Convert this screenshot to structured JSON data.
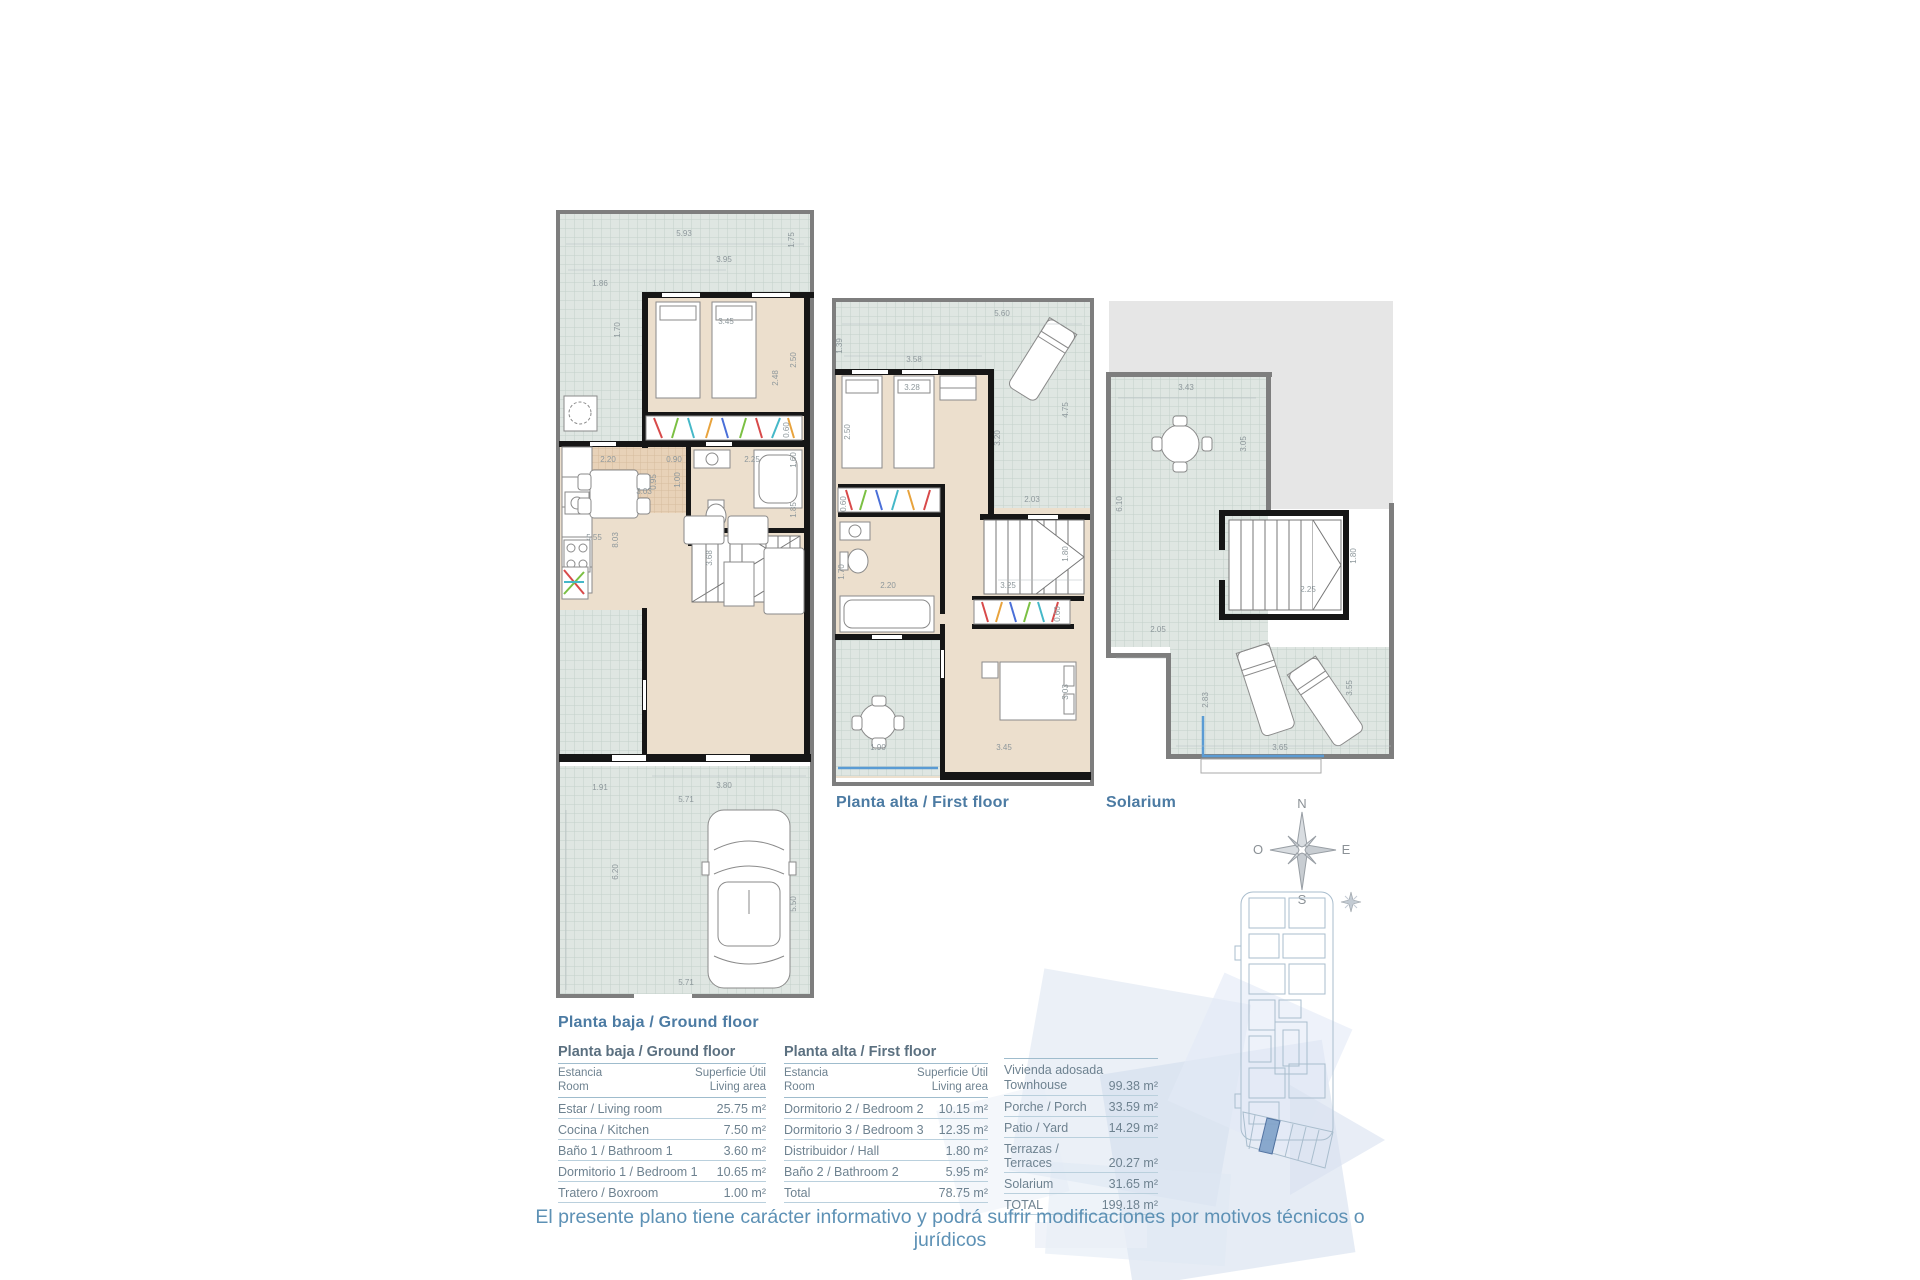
{
  "plans": {
    "ground": {
      "label": "Planta baja / Ground floor",
      "dims": [
        "5.93",
        "1.75",
        "3.95",
        "1.86",
        "1.70",
        "3.45",
        "2.50",
        "2.48",
        "0.60",
        "2.20",
        "0.90",
        "2.25",
        "1.60",
        "8.03",
        "1.00",
        "0.95",
        "3.03",
        "5.55",
        "3.68",
        "1.85",
        "1.91",
        "3.80",
        "5.71",
        "6.20",
        "5.50",
        "5.71"
      ]
    },
    "first": {
      "label": "Planta alta / First floor",
      "dims": [
        "5.60",
        "1.39",
        "3.58",
        "3.28",
        "2.50",
        "4.75",
        "3.20",
        "2.03",
        "0.60",
        "2.20",
        "1.70",
        "1.80",
        "3.25",
        "0.60",
        "3.03",
        "3.45",
        "1.90"
      ]
    },
    "solarium": {
      "label": "Solarium",
      "dims": [
        "3.43",
        "3.05",
        "6.10",
        "1.80",
        "2.25",
        "2.05",
        "2.83",
        "3.65",
        "3.55"
      ]
    }
  },
  "compass": {
    "n": "N",
    "e": "E",
    "s": "S",
    "o": "O"
  },
  "tables": {
    "ground": {
      "title": "Planta baja / Ground floor",
      "col_room_l1": "Estancia",
      "col_room_l2": "Room",
      "col_area_l1": "Superficie Útil",
      "col_area_l2": "Living area",
      "rows": [
        {
          "label": "Estar / Living room",
          "value": "25.75 m²"
        },
        {
          "label": "Cocina / Kitchen",
          "value": "7.50 m²"
        },
        {
          "label": "Baño 1 / Bathroom 1",
          "value": "3.60 m²"
        },
        {
          "label": "Dormitorio 1 / Bedroom 1",
          "value": "10.65 m²"
        },
        {
          "label": "Tratero / Boxroom",
          "value": "1.00 m²"
        }
      ]
    },
    "first": {
      "title": "Planta alta /  First floor",
      "col_room_l1": "Estancia",
      "col_room_l2": "Room",
      "col_area_l1": "Superficie Útil",
      "col_area_l2": "Living area",
      "rows": [
        {
          "label": "Dormitorio 2 / Bedroom 2",
          "value": "10.15 m²"
        },
        {
          "label": "Dormitorio 3 / Bedroom 3",
          "value": "12.35 m²"
        },
        {
          "label": "Distribuidor / Hall",
          "value": "1.80 m²"
        },
        {
          "label": "Baño 2 / Bathroom 2",
          "value": "5.95 m²"
        },
        {
          "label": "Total",
          "value": "78.75 m²"
        }
      ]
    },
    "totals": {
      "row0_label_l1": "Vivienda adosada",
      "row0_label_l2": "Townhouse",
      "row0_value": "99.38 m²",
      "rows": [
        {
          "label": "Porche / Porch",
          "value": "33.59 m²"
        },
        {
          "label": "Patio / Yard",
          "value": "14.29 m²"
        },
        {
          "label": "Terrazas / Terraces",
          "value": "20.27 m²"
        },
        {
          "label": "Solarium",
          "value": "31.65 m²"
        },
        {
          "label": "TOTAL",
          "value": "199.18 m²"
        }
      ]
    }
  },
  "disclaimer": "El presente plano tiene carácter informativo y podrá sufrir modificaciones por motivos técnicos o jurídicos",
  "colors": {
    "accent_blue": "#4c7ba3",
    "table_text": "#6e8290",
    "highlight_unit": "#7fa1c9",
    "tile": "#dfe6e2",
    "floor": "#ecdfcd",
    "terrace_edge": "#5a9bd4"
  }
}
